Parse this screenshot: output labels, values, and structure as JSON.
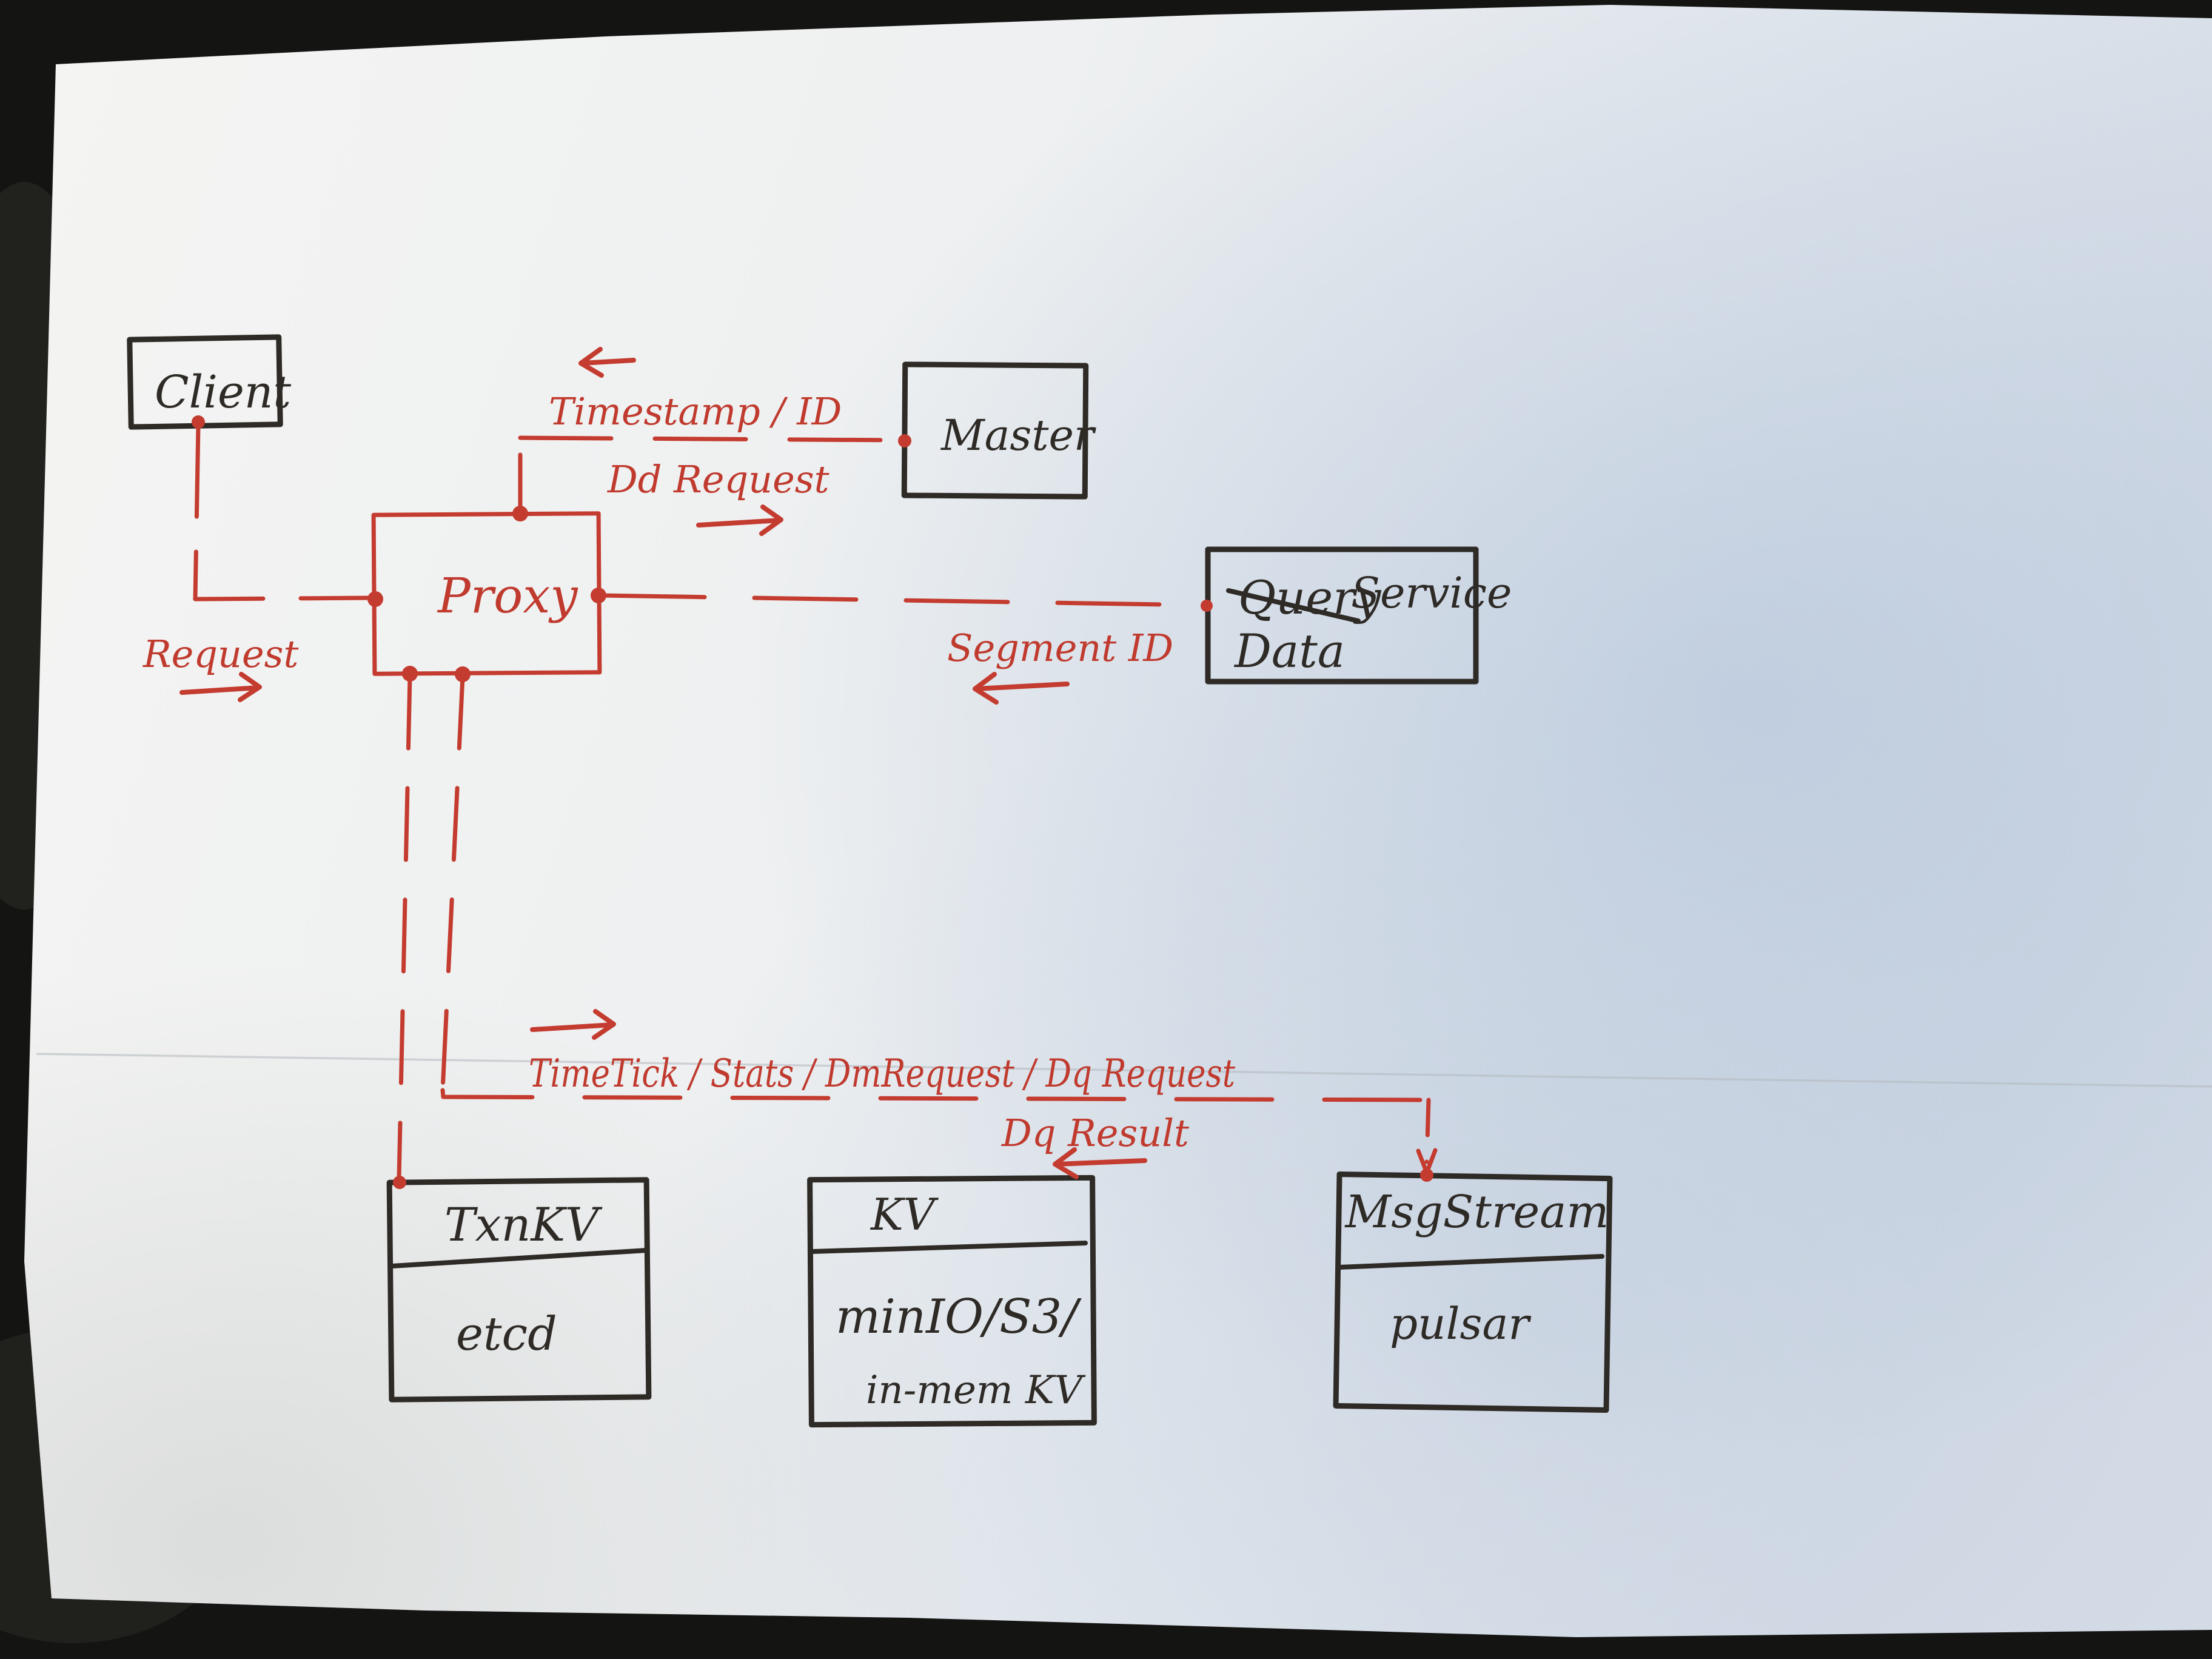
{
  "colors": {
    "background": "#141412",
    "paper": "#f1f2f3",
    "paper_shadow_blue": "#a9bdd6",
    "ink": "#2e2a26",
    "red": "#c43b2f"
  },
  "nodes": {
    "client": {
      "label": "Client"
    },
    "master": {
      "label": "Master"
    },
    "proxy": {
      "label": "Proxy"
    },
    "data_service": {
      "crossed_out": "Query",
      "suffix": "Service",
      "replacement": "Data"
    },
    "txn_kv": {
      "title": "TxnKV",
      "body": "etcd"
    },
    "kv": {
      "title": "KV",
      "body_line1": "minIO/S3/",
      "body_line2": "in-mem KV"
    },
    "msg_stream": {
      "title": "MsgStream",
      "body": "pulsar"
    }
  },
  "edges": {
    "client_proxy": {
      "label": "Request"
    },
    "proxy_master": {
      "label_above": "Timestamp / ID",
      "label_below": "Dd Request"
    },
    "proxy_data_service": {
      "label": "Segment ID"
    },
    "proxy_msg_stream": {
      "label_above": "TimeTick / Stats / DmRequest / Dq Request",
      "label_below": "Dq Result"
    }
  }
}
